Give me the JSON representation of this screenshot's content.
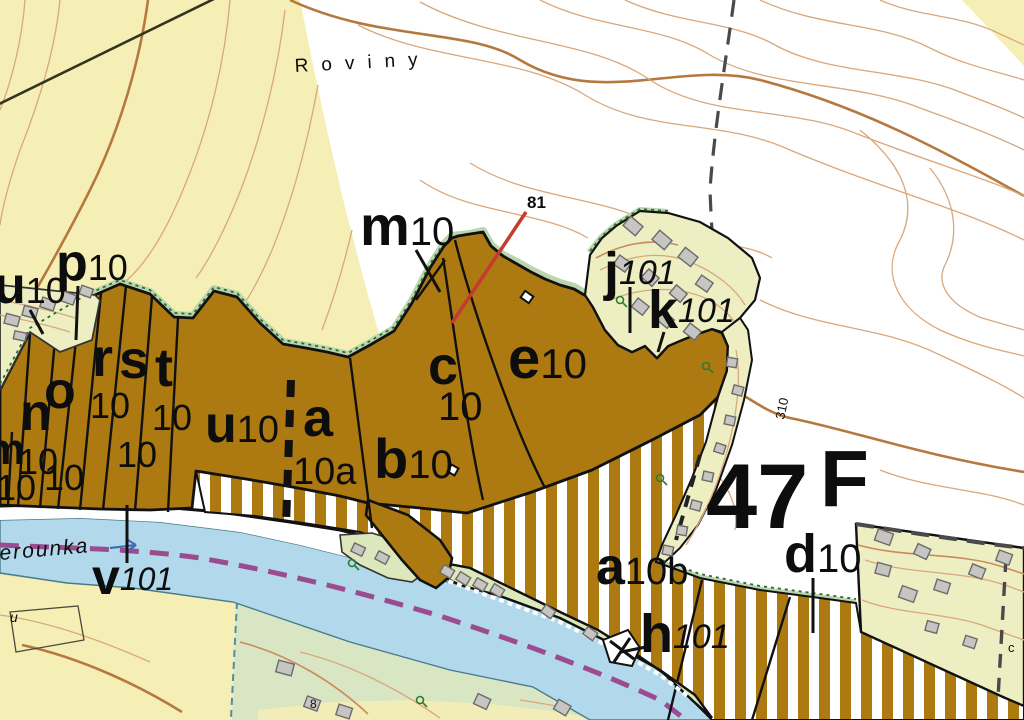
{
  "map": {
    "title": "forest-management-map",
    "labels": {
      "roviny": "Roviny",
      "berounka": "Berounka",
      "num_81": "81",
      "contour_310": "310",
      "compartment_47": "47",
      "compartment_F": "F",
      "small_u": "u",
      "small_8": "8",
      "small_c": "c"
    },
    "stands": {
      "m10_top": {
        "letter": "m",
        "num": "10"
      },
      "u10_strip": {
        "letter": "u",
        "num": "10"
      },
      "p10": {
        "letter": "p",
        "num": "10"
      },
      "m_left": {
        "letter": "m",
        "num": "10"
      },
      "n10": {
        "letter": "n",
        "num": "10"
      },
      "o10": {
        "letter": "o",
        "num": "10"
      },
      "r10": {
        "letter": "r",
        "num": "10"
      },
      "s10": {
        "letter": "s",
        "num": "10"
      },
      "t10": {
        "letter": "t",
        "num": "10"
      },
      "u10": {
        "letter": "u",
        "num": "10"
      },
      "a10a": {
        "letter": "a",
        "num": "10a"
      },
      "b10": {
        "letter": "b",
        "num": "10"
      },
      "c10": {
        "letter": "c",
        "num": "10"
      },
      "e10": {
        "letter": "e",
        "num": "10"
      },
      "j101": {
        "letter": "j",
        "num": "101"
      },
      "k101": {
        "letter": "k",
        "num": "101"
      },
      "d10": {
        "letter": "d",
        "num": "10"
      },
      "a10b": {
        "letter": "a",
        "num": "10b"
      },
      "h101": {
        "letter": "h",
        "num": "101"
      },
      "v101": {
        "letter": "v",
        "num": "101"
      }
    },
    "colors": {
      "forest_stand": "#AC7A10",
      "field_yellow": "#F6EFB5",
      "settlement": "#EDEFC3",
      "river": "#B2D8EC",
      "boundary_purple": "#9B4B8F",
      "red_line": "#C63A31",
      "contour": "#D9A77C",
      "green_fringe": "#2E6B30"
    }
  }
}
